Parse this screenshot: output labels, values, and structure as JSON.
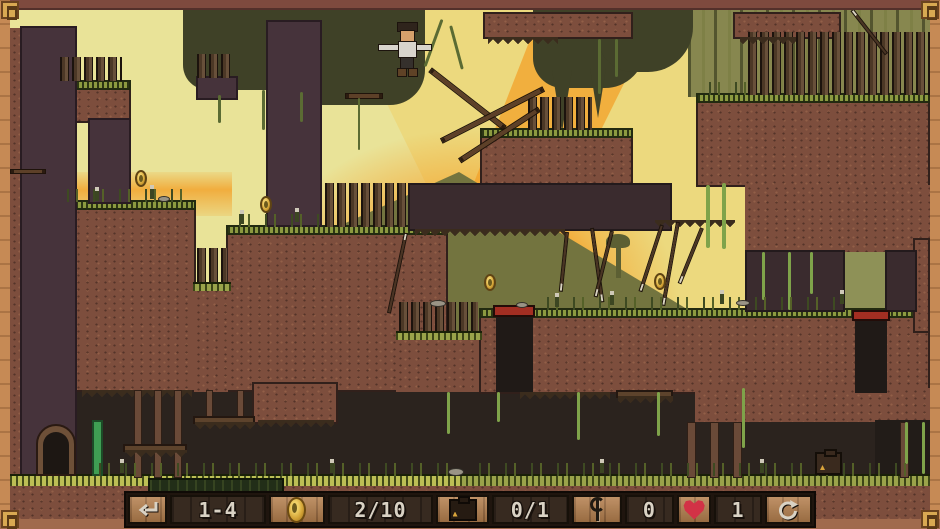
{
  "hud": {
    "back_button": {
      "icon": "return-arrow",
      "glyph": "↵"
    },
    "restart_button": {
      "icon": "restart-arrow",
      "glyph": "↻"
    },
    "level": {
      "label": "1-4"
    },
    "coins": {
      "icon": "coin",
      "count": "2/10"
    },
    "chests": {
      "icon": "chest",
      "count": "0/1"
    },
    "saplings": {
      "icon": "sapling",
      "count": "0"
    },
    "lives": {
      "icon": "heart",
      "count": "1"
    }
  },
  "colors": {
    "heart_red": "#d23246",
    "coin_gold": "#d2a235",
    "trap_red": "#a32e22",
    "hud_text": "#d9d2c4",
    "hud_panel_wood": "#b5804e",
    "hud_panel_dark": "#372a20",
    "frame_wood": "#c68a55",
    "corner_gold": "#d8a952",
    "sky_yellow": "#ecd97e",
    "sun_orange": "#f3a42e",
    "mountain_olive": "#73743f",
    "dirt_brown": "#7d4e3d",
    "dark_wall": "#46333b",
    "grass_green": "#8c9a40"
  },
  "scene": {
    "player": {
      "name": "player-character",
      "state": "airborne-arms-out"
    },
    "coins_visible": 4,
    "props": [
      "door",
      "chest",
      "picket-fences",
      "hanging-spikes",
      "vines",
      "red-trap-pits",
      "hanging-platforms"
    ]
  }
}
